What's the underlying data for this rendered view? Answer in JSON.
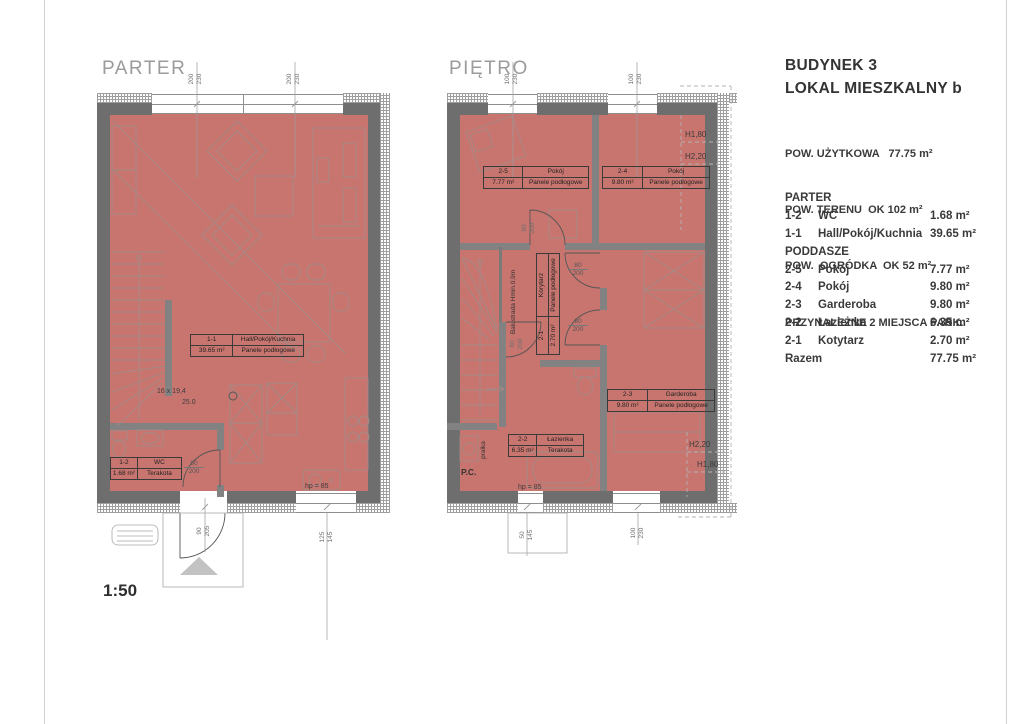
{
  "colors": {
    "floor": "#c9756f",
    "exterior_wall": "#6e6e6e",
    "interior_wall": "#828282",
    "title_gray": "#9b9b9b",
    "text": "#3a3a3a"
  },
  "scale": "1:50",
  "parter": {
    "title": "PARTER",
    "hall": {
      "id": "1-1",
      "name": "Hall/Pokój/Kuchnia",
      "area": "39.65 m²",
      "finish": "Panele podłogowe"
    },
    "wc": {
      "id": "1-2",
      "name": "WC",
      "area": "1.68 m²",
      "finish": "Terakota"
    },
    "stairs_line1": "16 x 19,4",
    "stairs_line2": "25.0",
    "hp": "hp = 85",
    "dims": {
      "win_top_1": {
        "w": "200",
        "h": "230"
      },
      "win_top_2": {
        "w": "200",
        "h": "230"
      },
      "entry": {
        "w": "90",
        "h": "205"
      },
      "win_bottom": {
        "w": "125",
        "h": "145"
      },
      "wc_door": {
        "w": "80",
        "h": "200"
      }
    }
  },
  "pietro": {
    "title": "PIĘTRO",
    "r25": {
      "id": "2-5",
      "name": "Pokój",
      "area": "7.77 m²",
      "finish": "Panele podłogowe"
    },
    "r24": {
      "id": "2-4",
      "name": "Pokój",
      "area": "9.80 m²",
      "finish": "Panele podłogowe"
    },
    "r23": {
      "id": "2-3",
      "name": "Garderoba",
      "area": "9.80 m²",
      "finish": "Panele podłogowe"
    },
    "r22": {
      "id": "2-2",
      "name": "Łazienka",
      "area": "6.35 m²",
      "finish": "Terakota"
    },
    "r21": {
      "id": "2-1",
      "name": "Korytarz",
      "area": "2.70 m²",
      "finish": "Panele podłogowe"
    },
    "balustrade1": "Balustrada",
    "balustrade2": "Hmin.0,9m",
    "pralka": "pralka",
    "pc": "P.C.",
    "hp": "hp = 85",
    "door": {
      "w": "80",
      "h": "200"
    },
    "dims": {
      "win_top_1": {
        "w": "100",
        "h": "230"
      },
      "win_top_2": {
        "w": "100",
        "h": "230"
      },
      "win_bottom_1": {
        "w": "50",
        "h": "145"
      },
      "win_bottom_2": {
        "w": "100",
        "h": "230"
      }
    },
    "heights": {
      "tr1": "H1,80",
      "tr2": "H2,20",
      "br1": "H2,20",
      "br2": "H1,80"
    }
  },
  "legend": {
    "building": "BUDYNEK 3",
    "unit": "LOKAL MIESZKALNY b",
    "specs": [
      "POW. UŻYTKOWA   77.75 m²",
      "POW. TERENU  OK 102 m²",
      "POW.  OGRÓDKA  OK 52 m²",
      "PRZYNALEŻNE 2 MIEJSCA PARK."
    ],
    "rows": [
      {
        "id": "PARTER",
        "name": "",
        "area": ""
      },
      {
        "id": "1-2",
        "name": "WC",
        "area": "1.68 m²"
      },
      {
        "id": "1-1",
        "name": "Hall/Pokój/Kuchnia",
        "area": "39.65 m²"
      },
      {
        "id": "PODDASZE",
        "name": "",
        "area": ""
      },
      {
        "id": "2-5",
        "name": "Pokój",
        "area": "7.77 m²"
      },
      {
        "id": "2-4",
        "name": "Pokój",
        "area": "9.80 m²"
      },
      {
        "id": "2-3",
        "name": "Garderoba",
        "area": "9.80 m²"
      },
      {
        "id": "2-2",
        "name": "Łazienka",
        "area": "6.35 m²"
      },
      {
        "id": "2-1",
        "name": "Kotytarz",
        "area": "2.70 m²"
      },
      {
        "id": "Razem",
        "name": "",
        "area": "77.75 m²"
      }
    ]
  }
}
